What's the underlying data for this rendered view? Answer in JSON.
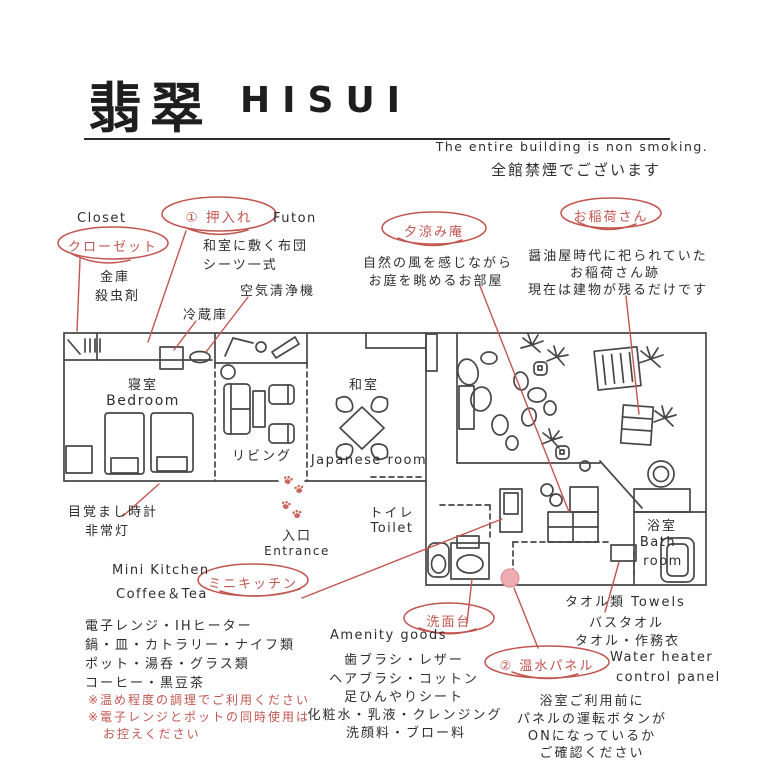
{
  "header": {
    "title_kanji": "翡翠",
    "title_romaji": "HISUI",
    "nonsmoking_en": "The entire building is non smoking.",
    "nonsmoking_ja": "全館禁煙でございます"
  },
  "colors": {
    "wall": "#474747",
    "accent_red": "#c2554f",
    "paw_red": "#c96a62",
    "pink_fill": "#ecacb0"
  },
  "rooms": {
    "bedroom_ja": "寝室",
    "bedroom_en": "Bedroom",
    "living_ja": "リビング",
    "japanese_ja": "和室",
    "japanese_en": "Japanese room",
    "entrance_ja": "入口",
    "entrance_en": "Entrance",
    "toilet_ja": "トイレ",
    "toilet_en": "Toilet",
    "bath_ja": "浴室",
    "bath_en1": "Bath",
    "bath_en2": "room"
  },
  "callouts": {
    "closet": {
      "en": "Closet",
      "oval": "クローゼット",
      "items": [
        "金庫",
        "殺虫剤"
      ]
    },
    "oshiire": {
      "oval": "① 押入れ",
      "side": "Futon",
      "desc": [
        "和室に敷く布団",
        "シーツ一式"
      ]
    },
    "fridge": {
      "label": "冷蔵庫"
    },
    "air_purifier": {
      "label": "空気清浄機"
    },
    "yusuzumi": {
      "oval": "夕涼み庵",
      "desc": [
        "自然の風を感じながら",
        "お庭を眺めるお部屋"
      ]
    },
    "oinari": {
      "oval": "お稲荷さん",
      "desc": [
        "醤油屋時代に祀られていた",
        "お稲荷さん跡",
        "現在は建物が残るだけです"
      ]
    },
    "alarm": {
      "lines": [
        "目覚まし時計",
        "非常灯"
      ]
    },
    "mini_kitchen": {
      "en1": "Mini Kitchen",
      "en2": "Coffee＆Tea",
      "oval": "ミニキッチン",
      "items": [
        "電子レンジ・IHヒーター",
        "鍋・皿・カトラリー・ナイフ類",
        "ポット・湯呑・グラス類",
        "コーヒー・黒豆茶"
      ],
      "warnings": [
        "※温め程度の調理でご利用ください",
        "※電子レンジとポットの同時使用は",
        "お控えください"
      ]
    },
    "washstand": {
      "oval": "洗面台",
      "en": "Amenity goods",
      "items": [
        "歯ブラシ・レザー",
        "ヘアブラシ・コットン",
        "足ひんやりシート",
        "化粧水・乳液・クレンジング",
        "洗顔料・ブロー料"
      ]
    },
    "water_heater": {
      "oval": "② 温水パネル",
      "en": [
        "Water heater",
        "control panel"
      ],
      "desc": [
        "浴室ご利用前に",
        "パネルの運転ボタンが",
        "ONになっているか",
        "ご確認ください"
      ]
    },
    "towels": {
      "title": "タオル類 Towels",
      "items": [
        "バスタオル",
        "タオル・作務衣"
      ]
    }
  }
}
